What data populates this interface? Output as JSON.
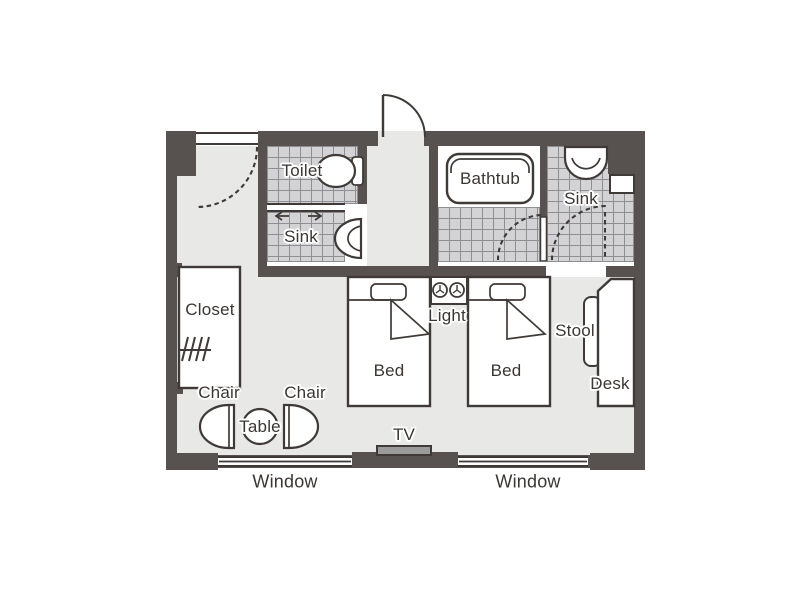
{
  "colors": {
    "wall": "#57524f",
    "outline": "#3f3a37",
    "floor": "#e8e8e7",
    "tile": "#d3d3d5",
    "tile_line": "#8f8f93",
    "tv": "#9b9b9b",
    "text": "#3b3633",
    "white": "#ffffff"
  },
  "labels": {
    "toilet": "Toilet",
    "sink_left": "Sink",
    "bathtub": "Bathtub",
    "sink_right": "Sink",
    "closet": "Closet",
    "chair_left": "Chair",
    "chair_right": "Chair",
    "table": "Table",
    "bed_left": "Bed",
    "bed_right": "Bed",
    "light": "Light",
    "stool": "Stool",
    "desk": "Desk",
    "tv": "TV",
    "window_left": "Window",
    "window_right": "Window"
  }
}
